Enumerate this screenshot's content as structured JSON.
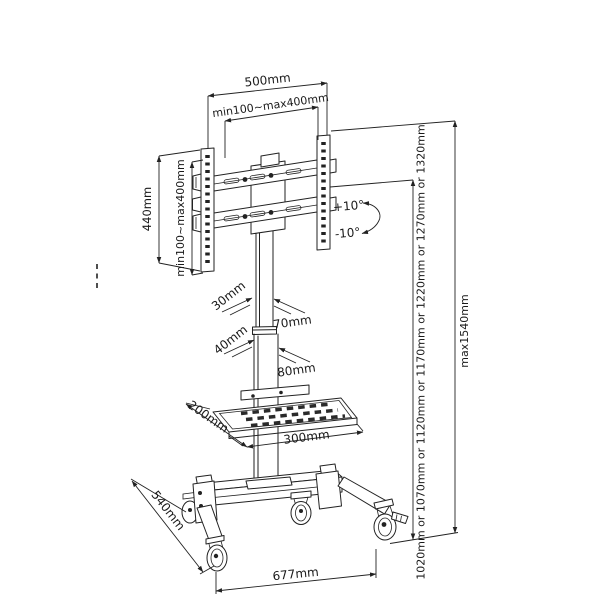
{
  "figure": {
    "type": "technical-line-drawing",
    "subject": "Mobile TV cart floor stand with tilting VESA mount, height-adjustable column, AV shelf and locking casters",
    "background_color": "#ffffff",
    "line_color": "#222222"
  },
  "labels": {
    "mount_width": "500mm",
    "vesa_width_range": "min100~max400mm",
    "mount_height": "440mm",
    "vesa_height_range": "min100~max400mm",
    "tilt_up": "+10°",
    "tilt_down": "-10°",
    "upper_column_depth": "30mm",
    "upper_column_width": "70mm",
    "lower_column_depth": "40mm",
    "lower_column_width": "80mm",
    "shelf_depth": "200mm",
    "shelf_width": "300mm",
    "base_depth": "540mm",
    "base_width": "677mm",
    "display_height_options": "1020mm or 1070mm or 1120mm or 1170mm or 1220mm or 1270mm or 1320mm",
    "max_height": "max1540mm"
  }
}
